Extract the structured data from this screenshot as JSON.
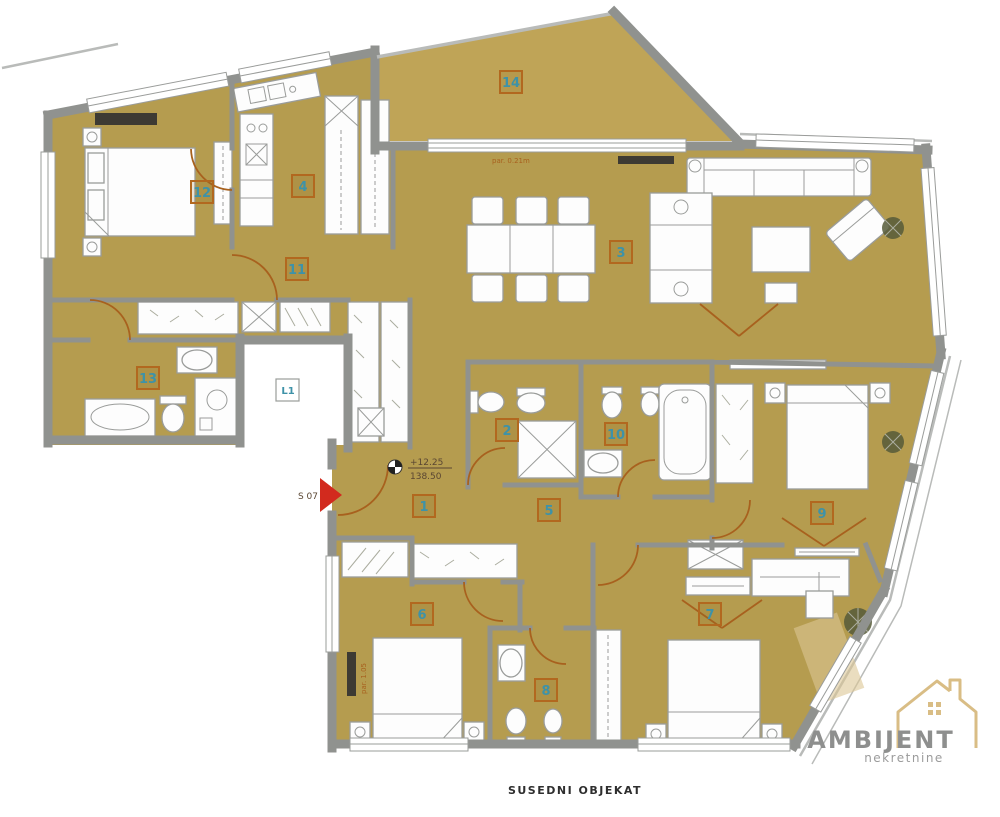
{
  "document": {
    "type": "apartment-floor-plan"
  },
  "rooms": [
    {
      "id": "1"
    },
    {
      "id": "2"
    },
    {
      "id": "3"
    },
    {
      "id": "4"
    },
    {
      "id": "5"
    },
    {
      "id": "6"
    },
    {
      "id": "7"
    },
    {
      "id": "8"
    },
    {
      "id": "9"
    },
    {
      "id": "10"
    },
    {
      "id": "11"
    },
    {
      "id": "12"
    },
    {
      "id": "13"
    },
    {
      "id": "14"
    },
    {
      "id": "L1"
    }
  ],
  "annotations": {
    "unit_label": "S 07",
    "elevation": "+12.25",
    "area_value": "138.50",
    "parapet_top": "par. 0.21m",
    "parapet_left": "par. 1.05",
    "bottom_caption": "SUSEDNI OBJEKAT"
  },
  "logo": {
    "brand": "AMBIJENT",
    "tagline": "nekretnine"
  },
  "colors": {
    "floor": "#b59c4f",
    "terrace": "#bfa457",
    "wall": "#90928f",
    "wall_light": "#b9bbb9",
    "furniture": "#fdfdfd",
    "furniture_stroke": "#9a9c9a",
    "door": "#a8611e",
    "label_border": "#b2681f",
    "label_text": "#3e92a8",
    "arrow": "#d22a1e",
    "radiator": "#3d3a33",
    "annotation": "#5a4632",
    "patch": "#dcc795",
    "logo_text": "#8e8f8e",
    "logo_gold": "#d9bd85",
    "caption": "#2e2e2e"
  }
}
